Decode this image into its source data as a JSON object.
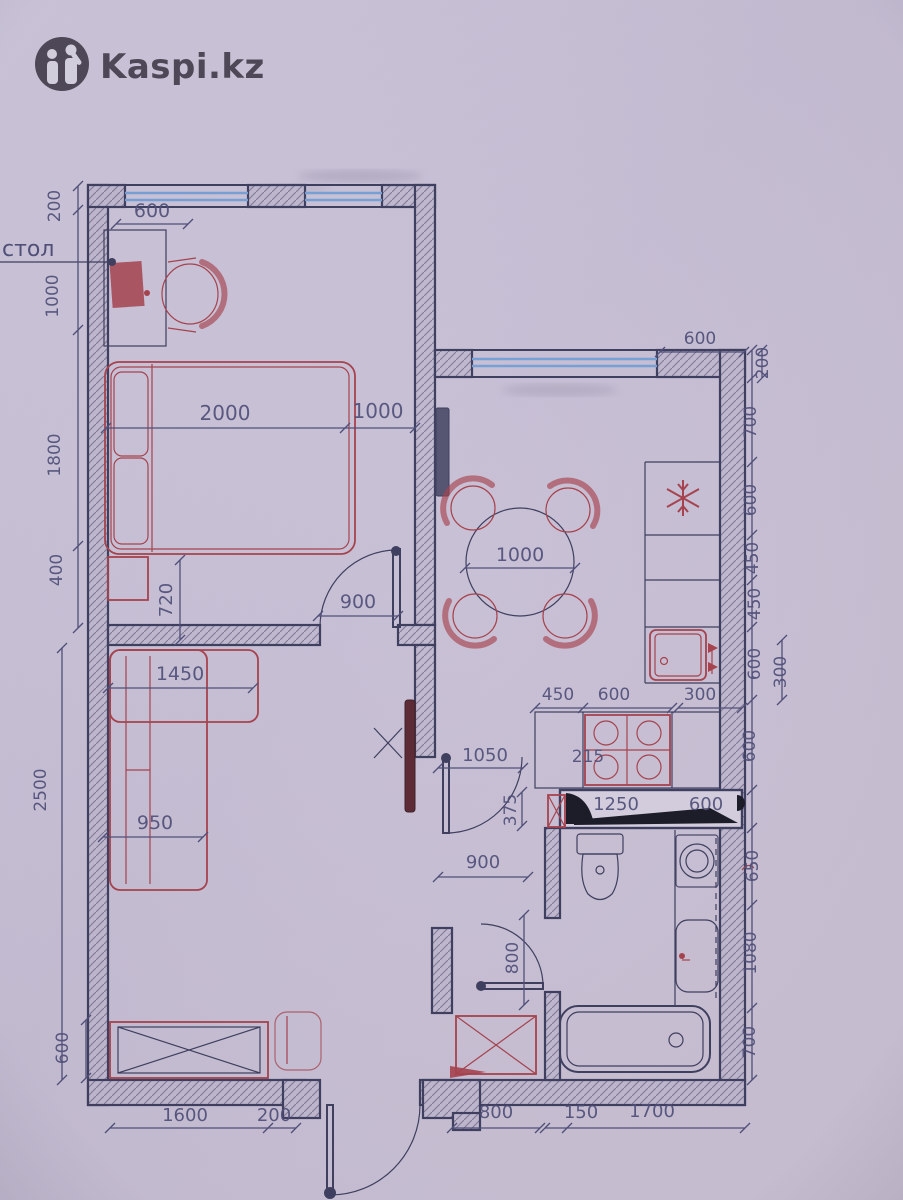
{
  "watermark": {
    "logo_text": "Kaspi.kz"
  },
  "palette": {
    "paper": "#cbc3d8",
    "wall": "#3f3f60",
    "dim": "#50507a",
    "red": "#a8434e",
    "blue": "#78a2d8",
    "logo": "#4e4857",
    "ink": "#1c1c28"
  },
  "callouts": {
    "desk_label": "стол"
  },
  "dimensions": [
    {
      "t": "200",
      "x": 60,
      "y": 206,
      "r": -90
    },
    {
      "t": "1000",
      "x": 58,
      "y": 296,
      "r": -90
    },
    {
      "t": "1800",
      "x": 60,
      "y": 455,
      "r": -90
    },
    {
      "t": "400",
      "x": 62,
      "y": 570,
      "r": -90
    },
    {
      "t": "2500",
      "x": 46,
      "y": 790,
      "r": -90
    },
    {
      "t": "600",
      "x": 68,
      "y": 1048,
      "r": -90
    },
    {
      "t": "600",
      "x": 152,
      "y": 217,
      "s": 19
    },
    {
      "t": "2000",
      "x": 225,
      "y": 420,
      "s": 20
    },
    {
      "t": "1000",
      "x": 378,
      "y": 418,
      "s": 20
    },
    {
      "t": "720",
      "x": 172,
      "y": 600,
      "r": -90,
      "s": 18
    },
    {
      "t": "900",
      "x": 358,
      "y": 608,
      "s": 19
    },
    {
      "t": "1450",
      "x": 180,
      "y": 680,
      "s": 19
    },
    {
      "t": "950",
      "x": 155,
      "y": 829,
      "s": 19
    },
    {
      "t": "600",
      "x": 700,
      "y": 344
    },
    {
      "t": "200",
      "x": 768,
      "y": 363,
      "r": -90
    },
    {
      "t": "700",
      "x": 756,
      "y": 422,
      "r": -90
    },
    {
      "t": "600",
      "x": 756,
      "y": 500,
      "r": -90
    },
    {
      "t": "450",
      "x": 758,
      "y": 558,
      "r": -90
    },
    {
      "t": "450",
      "x": 760,
      "y": 604,
      "r": -90
    },
    {
      "t": "600",
      "x": 760,
      "y": 664,
      "r": -90
    },
    {
      "t": "300",
      "x": 786,
      "y": 672,
      "r": -90
    },
    {
      "t": "600",
      "x": 755,
      "y": 746,
      "r": -90
    },
    {
      "t": "650",
      "x": 758,
      "y": 866,
      "r": -90
    },
    {
      "t": "1080",
      "x": 756,
      "y": 953,
      "r": -90
    },
    {
      "t": "700",
      "x": 755,
      "y": 1042,
      "r": -90
    },
    {
      "t": "1000",
      "x": 520,
      "y": 561,
      "s": 19
    },
    {
      "t": "450",
      "x": 558,
      "y": 700
    },
    {
      "t": "600",
      "x": 614,
      "y": 700
    },
    {
      "t": "300",
      "x": 700,
      "y": 700
    },
    {
      "t": "215",
      "x": 588,
      "y": 762
    },
    {
      "t": "1050",
      "x": 485,
      "y": 761,
      "s": 18
    },
    {
      "t": "375",
      "x": 516,
      "y": 810,
      "r": -90
    },
    {
      "t": "900",
      "x": 483,
      "y": 868,
      "s": 18
    },
    {
      "t": "1250",
      "x": 616,
      "y": 810,
      "s": 18
    },
    {
      "t": "600",
      "x": 706,
      "y": 810,
      "s": 18
    },
    {
      "t": "800",
      "x": 518,
      "y": 958,
      "r": -90
    },
    {
      "t": "1600",
      "x": 185,
      "y": 1121,
      "s": 18
    },
    {
      "t": "200",
      "x": 274,
      "y": 1121,
      "s": 18
    },
    {
      "t": "800",
      "x": 496,
      "y": 1118,
      "s": 18
    },
    {
      "t": "150",
      "x": 581,
      "y": 1118,
      "s": 18
    },
    {
      "t": "1700",
      "x": 652,
      "y": 1117,
      "s": 18
    }
  ]
}
